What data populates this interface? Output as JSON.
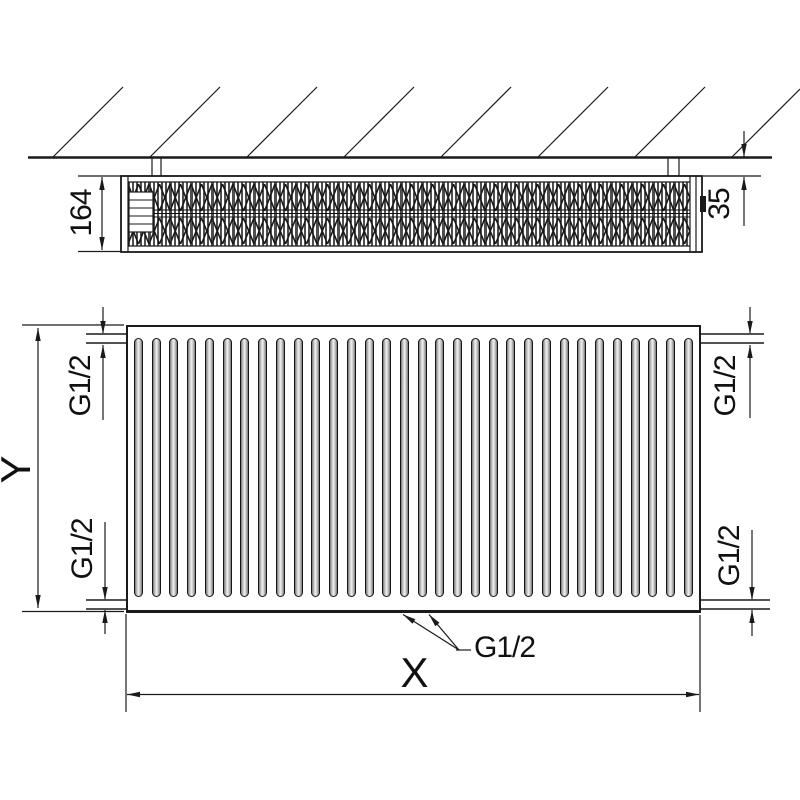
{
  "top_view": {
    "depth_mm": "164",
    "wall_distance_mm": "35"
  },
  "front_view": {
    "height_label": "Y",
    "width_label": "X",
    "channel_count": 32,
    "connections": {
      "top_left": "G1/2",
      "top_right": "G1/2",
      "bottom_left": "G1/2",
      "bottom_right": "G1/2",
      "bottom_center": "G1/2"
    }
  },
  "colors": {
    "line": "#1a1a1a",
    "background": "#ffffff",
    "channel_gray": "#c9c9c9"
  }
}
